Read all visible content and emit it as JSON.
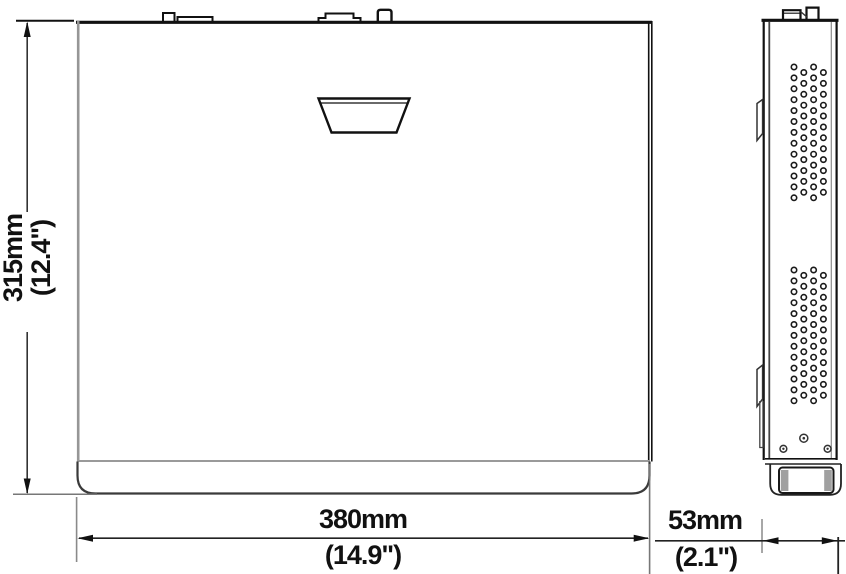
{
  "diagram": {
    "dimensions": {
      "height": {
        "metric": "315mm",
        "imperial": "(12.4\")"
      },
      "width": {
        "metric": "380mm",
        "imperial": "(14.9\")"
      },
      "depth": {
        "metric": "53mm",
        "imperial": "(2.1\")"
      }
    },
    "colors": {
      "line": "#1a1a1a",
      "gray_line": "#8e8e8e",
      "background": "#ffffff"
    },
    "vents": {
      "x": 794,
      "cols": 4,
      "col_spacing": 9.8,
      "row_spacing": 10.9,
      "stagger": 5.45,
      "hole_radius": 2.7,
      "stroke_width": 1.6,
      "groups": [
        {
          "y": 67,
          "rows": 13
        },
        {
          "y": 270,
          "rows": 13
        }
      ]
    }
  }
}
